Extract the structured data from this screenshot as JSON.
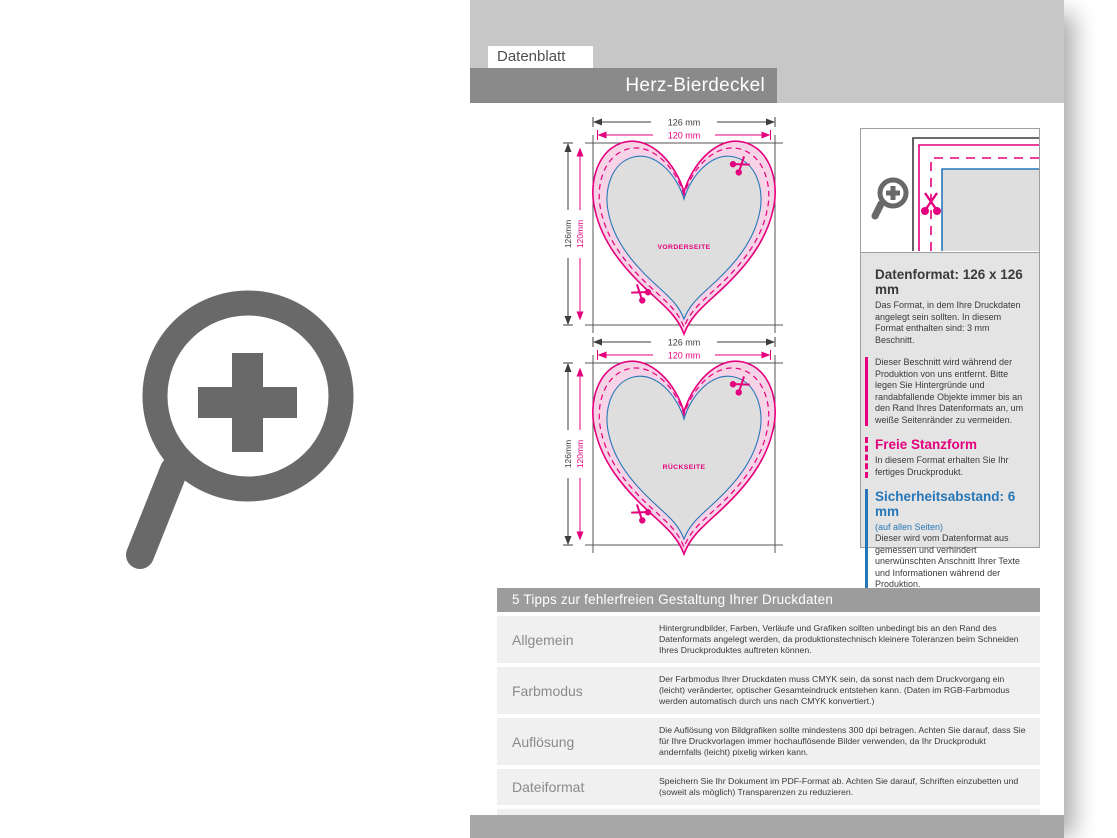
{
  "page": {
    "tab_label": "Datenblatt",
    "title": "Herz-Bierdeckel"
  },
  "colors": {
    "magenta": "#e5007d",
    "blue": "#2777b8",
    "band_gray": "#c7c7c7",
    "title_bar_gray": "#8a8a8a",
    "panel_gray": "#e4e4e4",
    "table_header_gray": "#9c9c9c",
    "row_gray": "#f0f0f0",
    "icon_gray": "#696969",
    "heart_fill_pink": "#f6d3e6",
    "heart_fill_gray": "#dedede"
  },
  "diagrams": {
    "front_label": "VORDERSEITE",
    "back_label": "RÜCKSEITE",
    "dim_width_outer": "126 mm",
    "dim_width_inner": "120 mm",
    "dim_height_outer": "126mm",
    "dim_height_inner": "120mm"
  },
  "info_panel": {
    "datenformat_title": "Datenformat: 126 x 126 mm",
    "datenformat_text": "Das Format, in dem Ihre Druckdaten angelegt sein sollten. In diesem Format enthalten sind: 3 mm Beschnitt.",
    "beschnitt_text": "Dieser Beschnitt wird während der Produktion von uns entfernt. Bitte legen Sie Hintergründe und randabfallende Objekte immer bis an den Rand Ihres Datenformats an, um weiße Seitenränder zu vermeiden.",
    "stanzform_title": "Freie Stanzform",
    "stanzform_text": "In diesem Format erhalten Sie Ihr fertiges Druckprodukt.",
    "sicherheit_title": "Sicherheitsabstand: 6 mm",
    "sicherheit_sub": "(auf allen Seiten)",
    "sicherheit_text": "Dieser wird vom Datenformat aus gemessen und verhindert unerwünschten Anschnitt Ihrer Texte und Informationen während der Produktion."
  },
  "tips_table": {
    "header": "5 Tipps zur fehlerfreien Gestaltung Ihrer Druckdaten",
    "rows": [
      {
        "label": "Allgemein",
        "text": "Hintergrundbilder, Farben, Verläufe und Grafiken sollten unbedingt bis an den Rand des Datenformats angelegt werden, da produktionstechnisch kleinere Toleranzen beim Schneiden Ihres Druckproduktes auftreten können."
      },
      {
        "label": "Farbmodus",
        "text": "Der Farbmodus Ihrer Druckdaten muss CMYK sein, da sonst nach dem Druckvorgang ein (leicht) veränderter, optischer Gesamteindruck entstehen kann. (Daten im RGB-Farbmodus werden automatisch durch uns nach CMYK konvertiert.)"
      },
      {
        "label": "Auflösung",
        "text": "Die Auflösung von Bildgrafiken sollte mindestens 300 dpi betragen. Achten Sie darauf, dass Sie für Ihre Druckvorlagen immer hochauflösende Bilder verwenden, da Ihr Druckprodukt andernfalls (leicht) pixelig wirken kann."
      },
      {
        "label": "Dateiformat",
        "text": "Speichern Sie Ihr Dokument im PDF-Format ab. Achten Sie darauf, Schriften einzubetten und (soweit als möglich) Transparenzen zu reduzieren."
      },
      {
        "label": "Seiten(-reihenfolge)",
        "text": "Senden Sie mehrseitige Dokumente chronologisch in korrekter Reihenfolge als eine einzige PDF-Datei oder benennen Sie Einzeldokumente entsprechend mit fortlaufenden Seitennummern."
      }
    ]
  }
}
